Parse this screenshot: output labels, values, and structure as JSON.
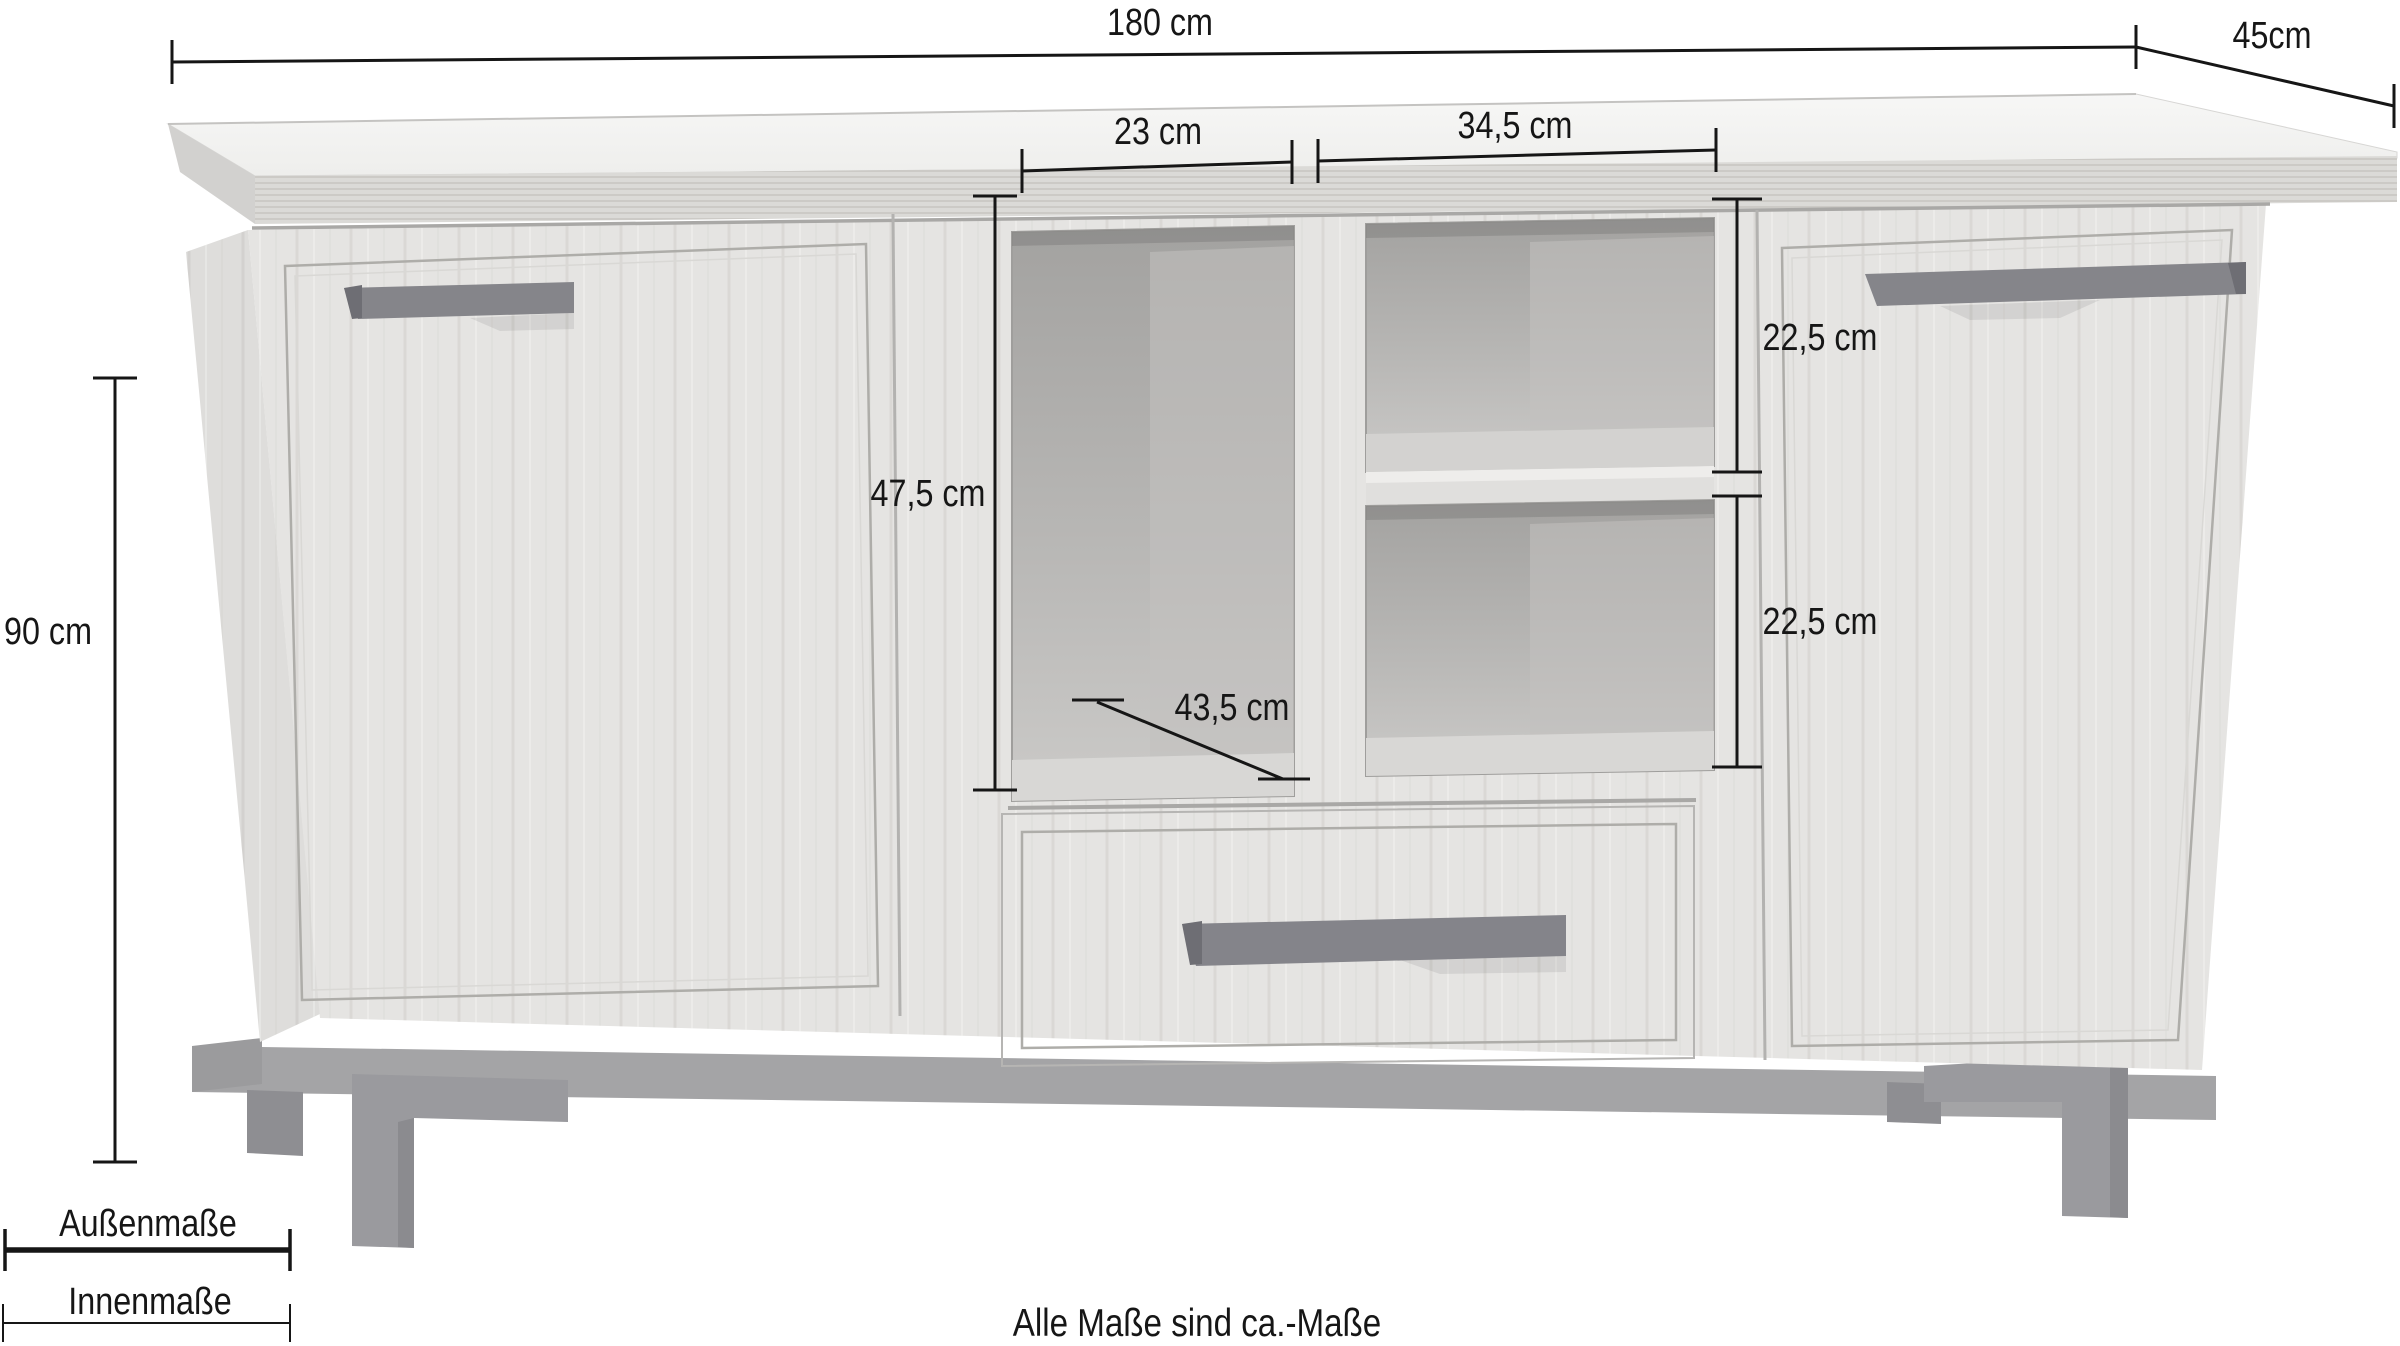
{
  "diagram": {
    "labels": {
      "total_width": "180 cm",
      "depth": "45cm",
      "total_height": "90 cm",
      "left_compartment_width": "23 cm",
      "right_compartment_width": "34,5 cm",
      "left_compartment_height": "47,5 cm",
      "right_compartment_top_height": "22,5 cm",
      "right_compartment_bottom_height": "22,5 cm",
      "compartment_depth": "43,5 cm"
    },
    "legend": {
      "outer_label": "Außenmaße",
      "inner_label": "Innenmaße"
    },
    "note": "Alle Maße sind ca.-Maße",
    "colors": {
      "dimension_line": "#161616",
      "wood_body": "#e5e4e2",
      "wood_top_surface": "#f4f4f3",
      "wood_top_edge": "#dbdad7",
      "interior_dark": "#a8a7a5",
      "interior_light": "#c9c8c6",
      "handle": "#84848a",
      "base_rail": "#a4a4a6",
      "legs": "#9a9a9e"
    }
  }
}
